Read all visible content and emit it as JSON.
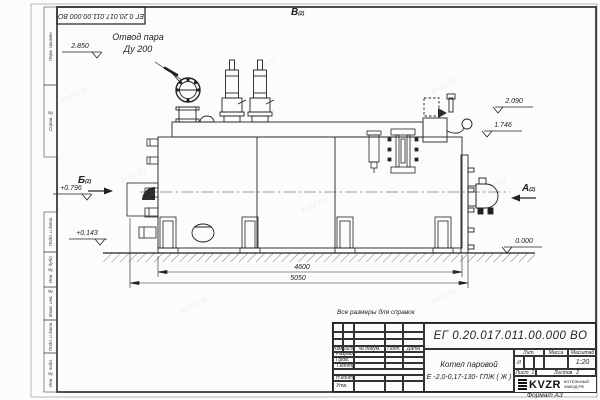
{
  "watermark": {
    "text": "kvzr.ru"
  },
  "stamp_top": {
    "doc_number": "ЕГ 0.20.017.011.00.000  ВО"
  },
  "frame": {
    "side_labels": [
      "Перв. примен.",
      "Справ. №",
      "Подп. и дата",
      "Инв. № дубл.",
      "Взам. инв. №",
      "Подп. и дата",
      "Инв. № подл."
    ]
  },
  "views": {
    "top": {
      "label": "В",
      "sheet": "(2)"
    },
    "left": {
      "label": "Б",
      "sheet": "(2)"
    },
    "right": {
      "label": "А",
      "sheet": "(2)"
    }
  },
  "callouts": {
    "steam_outlet_line1": "Отвод пара",
    "steam_outlet_line2": "Ду 200"
  },
  "elevations": {
    "e2850": "2.850",
    "e2090": "2.090",
    "e1746": "1.746",
    "e0796": "+0.796",
    "e0143": "+0.143",
    "e0000": "0.000"
  },
  "dimensions": {
    "length_inner": "4600",
    "length_overall": "5050"
  },
  "title_block": {
    "note": "Все размеры для справок",
    "doc_number": "ЕГ 0.20.017.011.00.000  ВО",
    "product_line1": "Котел паровой",
    "product_line2": "Е -2,0-0,17-130- ГЛЖ ( Ж )",
    "cols": {
      "izm": "Изм.",
      "list": "Лист",
      "doc": "№ докум.",
      "podp": "Подп.",
      "data": "Дата"
    },
    "rows": {
      "razrab": "Разраб.",
      "prov": "Пров.",
      "tkontr": "Т.контр.",
      "nkontr": "Н.контр.",
      "utv": "Утв."
    },
    "lit_header": "Лит.",
    "lit_value": "И",
    "mass_header": "Масса",
    "scale_header": "Масштаб",
    "scale_value": "1:20",
    "sheet_label": "Лист",
    "sheet_value": "1",
    "sheets_label": "Листов",
    "sheets_value": "2",
    "logo_text": "KVZR",
    "logo_sub1": "КОТЕЛЬНЫЙ",
    "logo_sub2": "ЗАВОД РФ",
    "format": "Формат  А3"
  }
}
